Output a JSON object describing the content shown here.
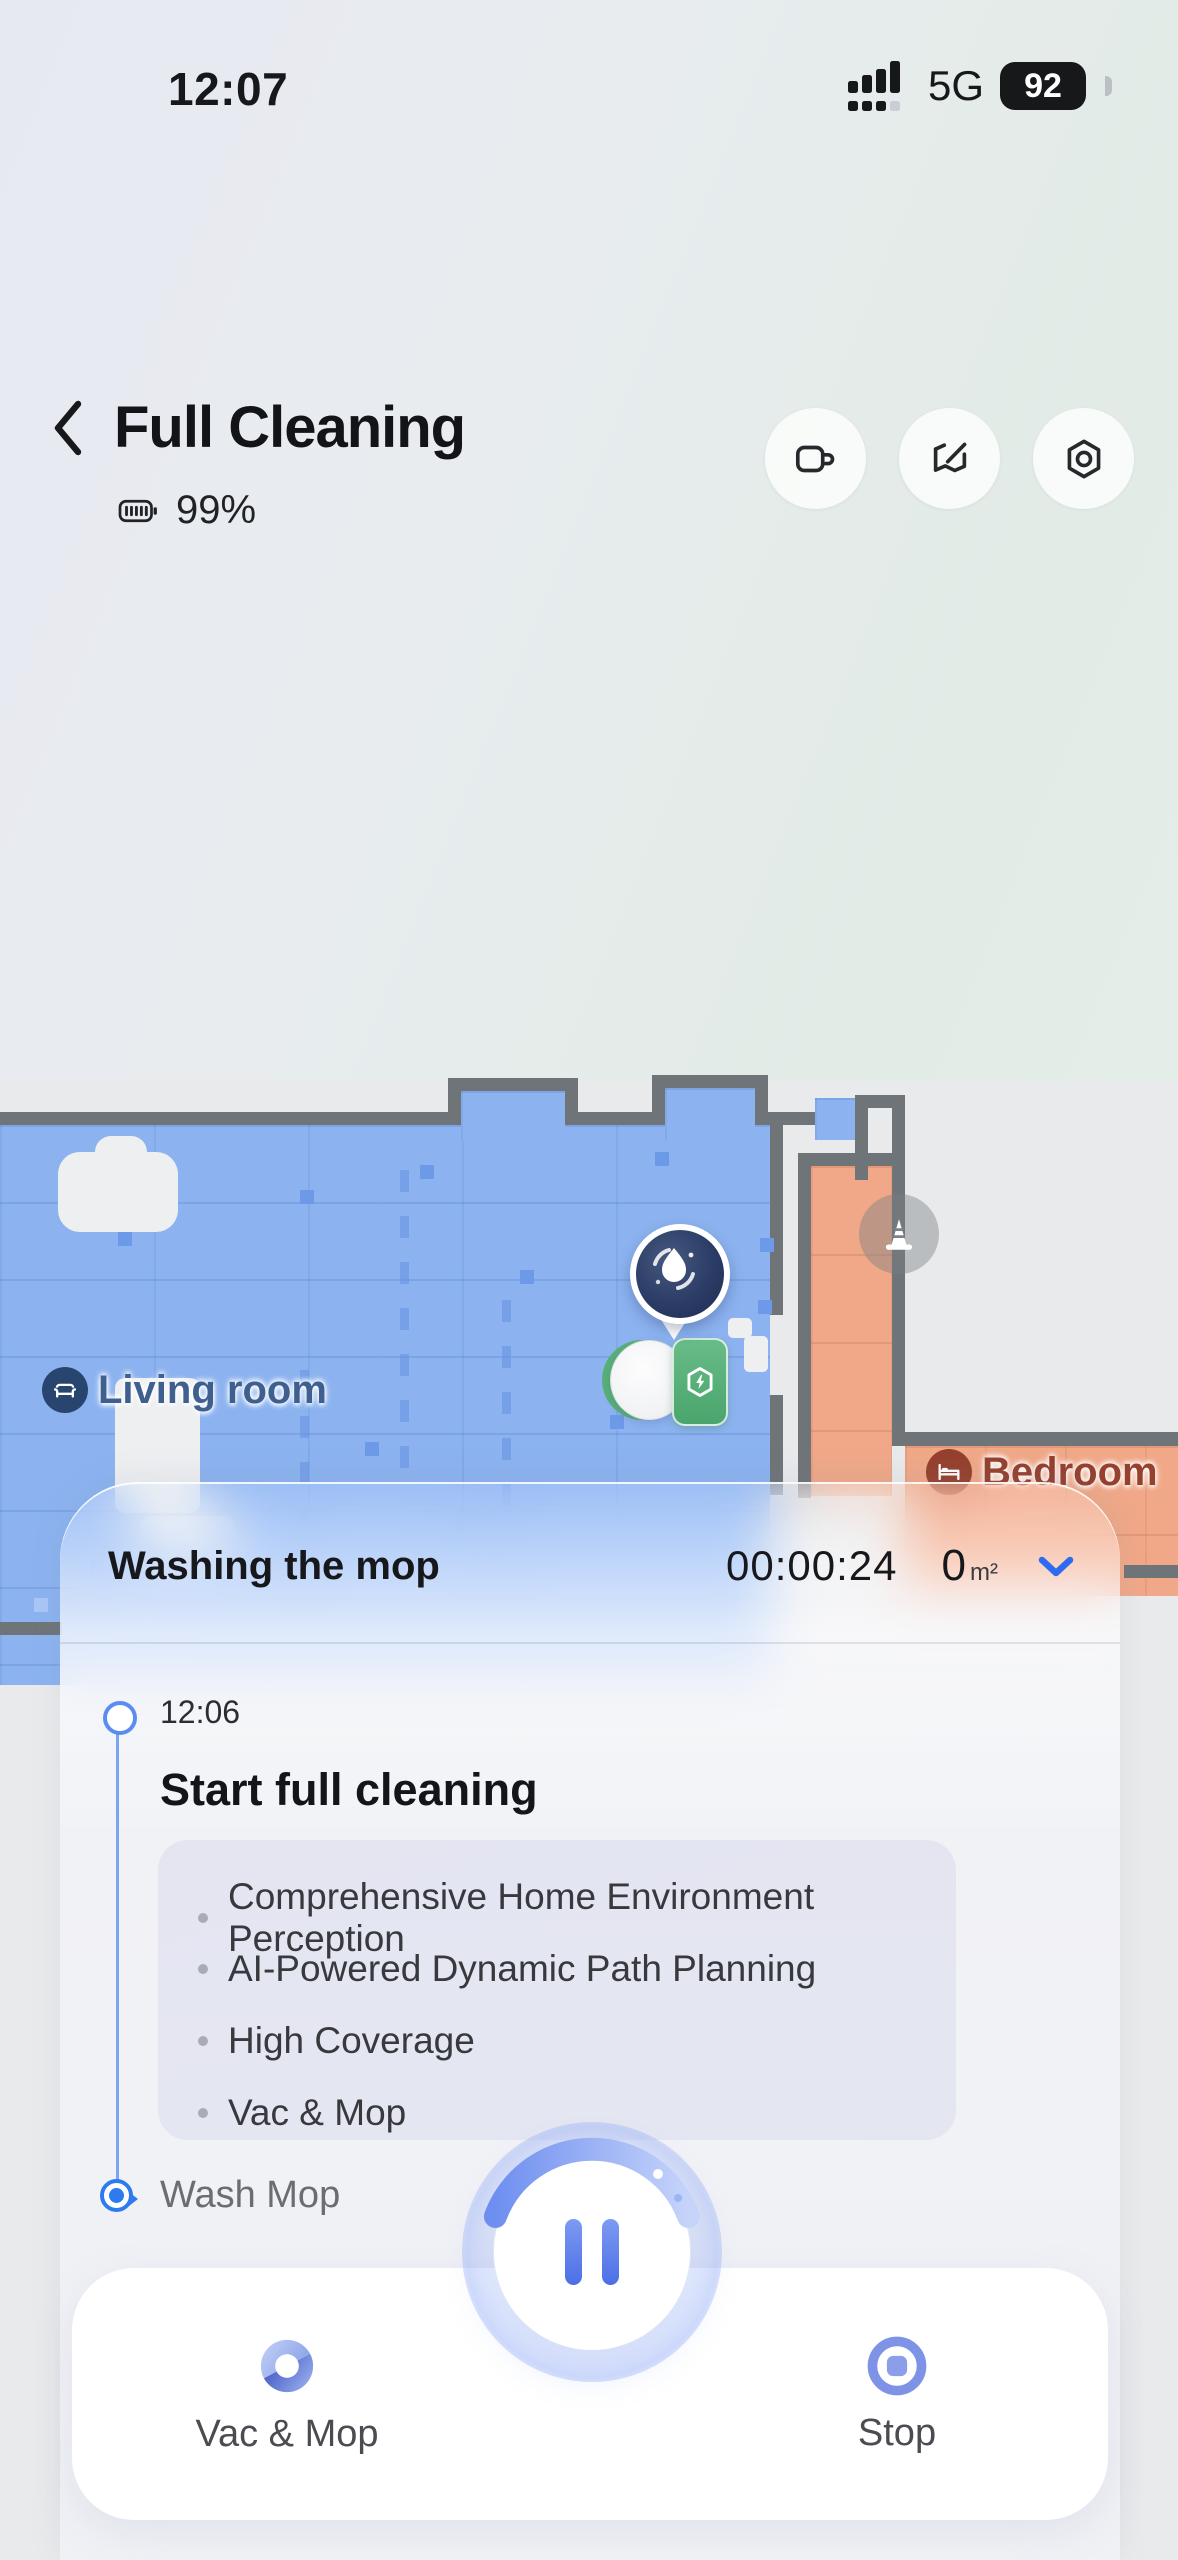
{
  "status_bar": {
    "time": "12:07",
    "network": "5G",
    "battery": "92"
  },
  "header": {
    "title": "Full Cleaning",
    "robot_battery": "99%"
  },
  "map": {
    "living_room": {
      "name": "Living room"
    },
    "bedroom": {
      "name": "Bedroom"
    }
  },
  "panel": {
    "status": "Washing the mop",
    "timer": "00:00:24",
    "area": "0",
    "area_unit": "m²"
  },
  "timeline": {
    "step1": {
      "time": "12:06",
      "title": "Start full cleaning",
      "bullets": [
        "Comprehensive Home Environment Perception",
        "AI-Powered Dynamic Path Planning",
        "High Coverage",
        "Vac & Mop"
      ]
    },
    "step2": {
      "title": "Wash Mop"
    }
  },
  "controls": {
    "vac_mop": "Vac & Mop",
    "stop": "Stop"
  },
  "colors": {
    "accent_blue": "#2e6bf0",
    "floor_blue": "#8cb3f0",
    "floor_orange": "#f0a888",
    "wall_gray": "#6f7478",
    "dock_green": "#55b07c"
  }
}
